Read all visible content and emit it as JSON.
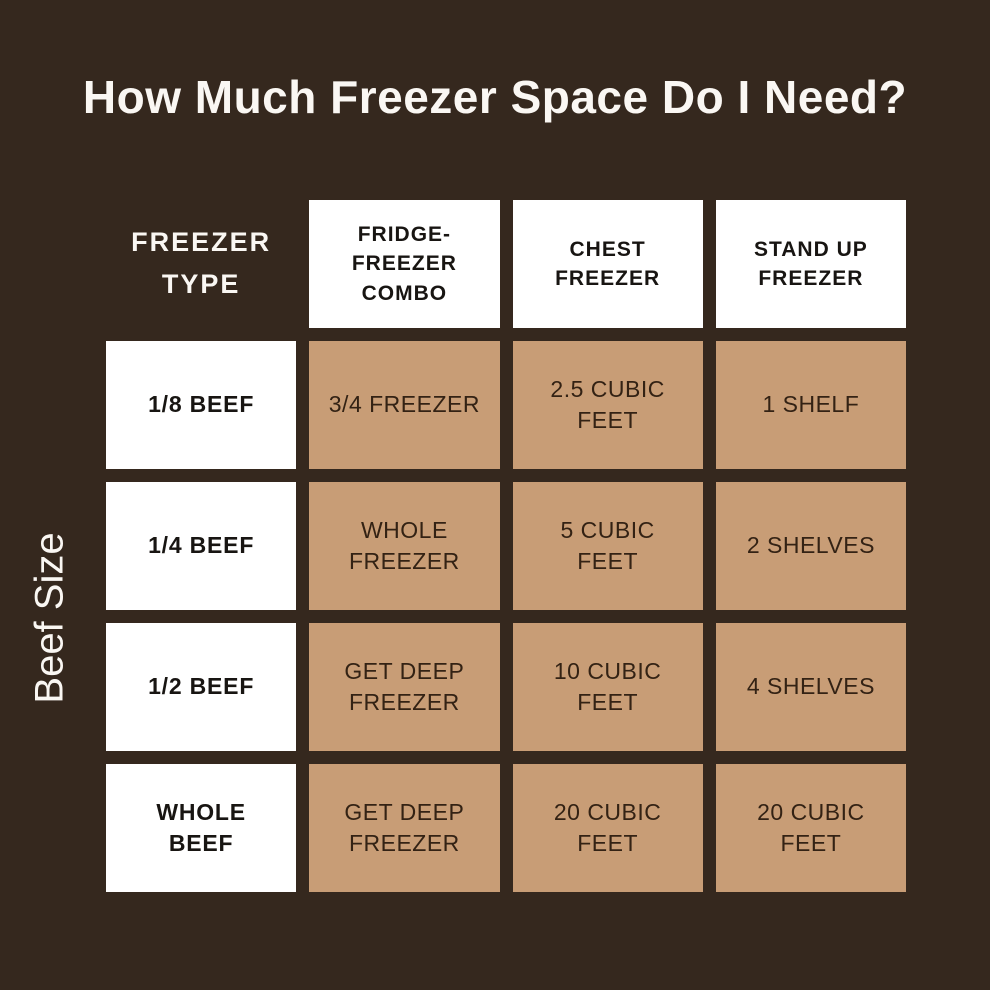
{
  "display": {
    "title": "How Much Freezer Space Do I Need?",
    "side_label": "Beef Size",
    "corner_label": "FREEZER\nTYPE",
    "headers": [
      "FRIDGE-\nFREEZER\nCOMBO",
      "CHEST\nFREEZER",
      "STAND UP\nFREEZER"
    ],
    "rows": [
      {
        "label": "1/8 BEEF",
        "cells": [
          "3/4 FREEZER",
          "2.5 CUBIC\nFEET",
          "1 SHELF"
        ]
      },
      {
        "label": "1/4 BEEF",
        "cells": [
          "WHOLE\nFREEZER",
          "5 CUBIC\nFEET",
          "2 SHELVES"
        ]
      },
      {
        "label": "1/2 BEEF",
        "cells": [
          "GET DEEP\nFREEZER",
          "10 CUBIC\nFEET",
          "4 SHELVES"
        ]
      },
      {
        "label": "WHOLE\nBEEF",
        "cells": [
          "GET DEEP\nFREEZER",
          "20 CUBIC\nFEET",
          "20 CUBIC\nFEET"
        ]
      }
    ]
  },
  "chart_data": {
    "type": "table",
    "title": "How Much Freezer Space Do I Need?",
    "row_axis_label": "Beef Size",
    "column_axis_label": "FREEZER TYPE",
    "columns": [
      "FRIDGE-FREEZER COMBO",
      "CHEST FREEZER",
      "STAND UP FREEZER"
    ],
    "rows": [
      "1/8 BEEF",
      "1/4 BEEF",
      "1/2 BEEF",
      "WHOLE BEEF"
    ],
    "cells": [
      [
        "3/4 FREEZER",
        "2.5 CUBIC FEET",
        "1 SHELF"
      ],
      [
        "WHOLE FREEZER",
        "5 CUBIC FEET",
        "2 SHELVES"
      ],
      [
        "GET DEEP FREEZER",
        "10 CUBIC FEET",
        "4 SHELVES"
      ],
      [
        "GET DEEP FREEZER",
        "20 CUBIC FEET",
        "20 CUBIC FEET"
      ]
    ],
    "layout": "matrix with header row and header column, grid gaps showing background"
  },
  "colors": {
    "background": "#35281e",
    "cell_white": "#ffffff",
    "cell_tan": "#c89d76",
    "text_light": "#faf7f3",
    "text_dark": "#181512",
    "text_data": "#332214"
  }
}
